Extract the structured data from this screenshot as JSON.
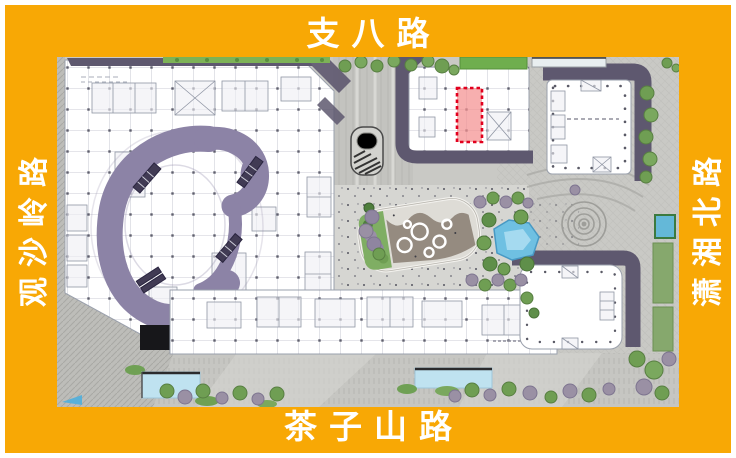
{
  "frame": {
    "background_color": "#F8A805",
    "text_color": "#FFFFFF",
    "labels": {
      "top": "支八路",
      "bottom": "茶子山路",
      "left": "观沙岭路",
      "right": "潇湘北路"
    }
  },
  "map": {
    "kind": "master-plan-site-map",
    "highlight_marker": {
      "stroke": "#E2001E",
      "fill": "#F49090",
      "style": "dashed-rectangle"
    },
    "colors": {
      "atrium_purple": "#8C83A6",
      "shadow_purple": "#5E586F",
      "paving_gray": "#C9C9C5",
      "plaza_gray": "#D6D6D2",
      "plan_white": "#FFFFFF",
      "water_blue": "#7FC4E4",
      "pool_blue": "#BFE2F0",
      "tree_green": "#6F9E53",
      "hedge_green": "#7DB257",
      "shrub_gray_purple": "#9A90A4"
    }
  }
}
